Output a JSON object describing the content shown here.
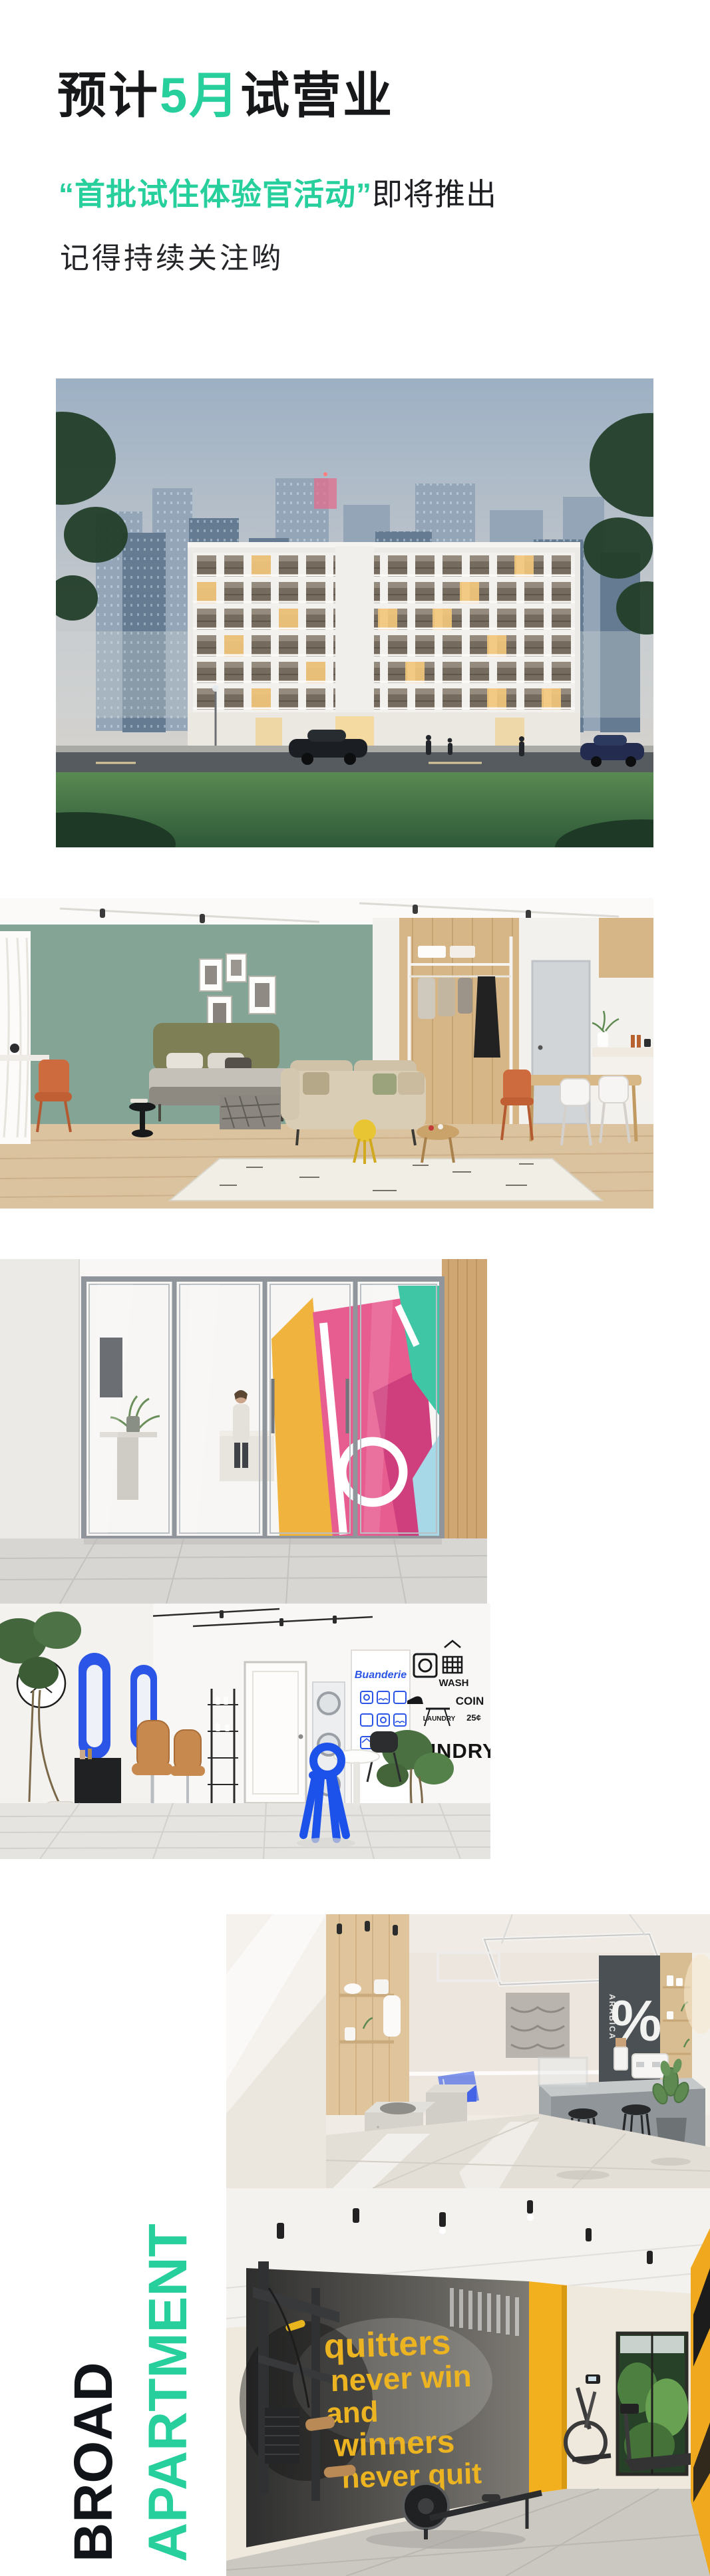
{
  "colors": {
    "accent_green": "#26cf9c",
    "ink_black": "#17181a",
    "laundry_blue": "#2b55e6",
    "gym_yellow": "#f0b02a"
  },
  "header": {
    "title_pre": "预计",
    "title_highlight": "5月",
    "title_post": "试营业",
    "line1_highlight": "“首批试住体验官活动”",
    "line1_rest": "即将推出",
    "line2": "记得持续关注哟"
  },
  "brand": {
    "word_black": "BROAD",
    "word_green": "APARTMENT"
  },
  "photo_text": {
    "laundry": {
      "sign_script": "Buanderie",
      "word_wash": "WASH",
      "word_coin": "COIN",
      "word_laundry_small": "LAUNDRY",
      "word_price": "25¢",
      "word_big": "LAUNDRY"
    },
    "cafe": {
      "percent_sign": "%",
      "vertical_sign": "ARABICA"
    },
    "gym": {
      "mural_line1": "quitters",
      "mural_line2": "never win",
      "mural_line3": "and",
      "mural_line4": "winners",
      "mural_line5": "never quit"
    }
  }
}
